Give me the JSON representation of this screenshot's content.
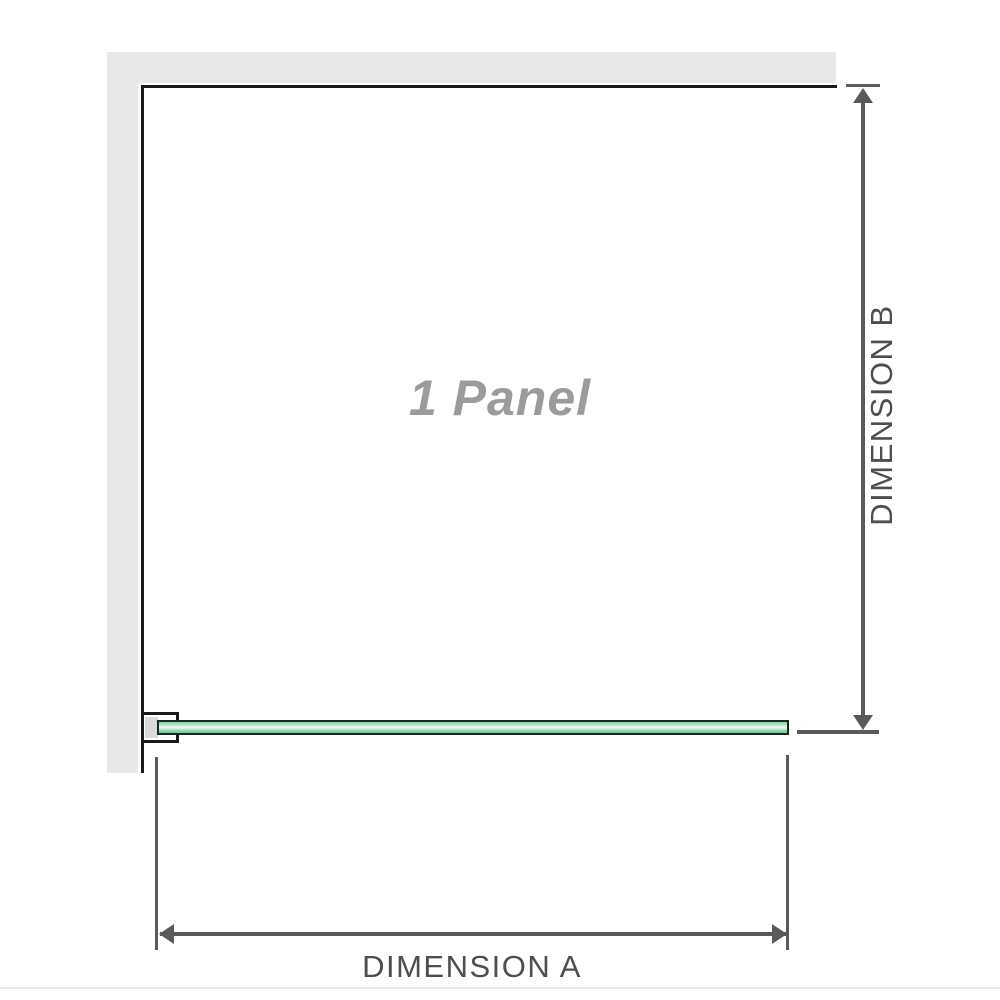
{
  "diagram": {
    "title": "1 Panel",
    "dimension_a": "DIMENSION A",
    "dimension_b": "DIMENSION B"
  },
  "colors": {
    "wall": "#e8e8e8",
    "outline": "#1a1a1a",
    "dimension_line": "#595a5c",
    "dimension_text": "#4d4e50",
    "panel_label": "#9b9b9b",
    "glass_green": "#8bd2a8",
    "glass_highlight": "#eefaf3",
    "glass_border": "#132a1d",
    "bracket_pad": "#d9d9d9",
    "page_divider": "#eae8e4"
  }
}
